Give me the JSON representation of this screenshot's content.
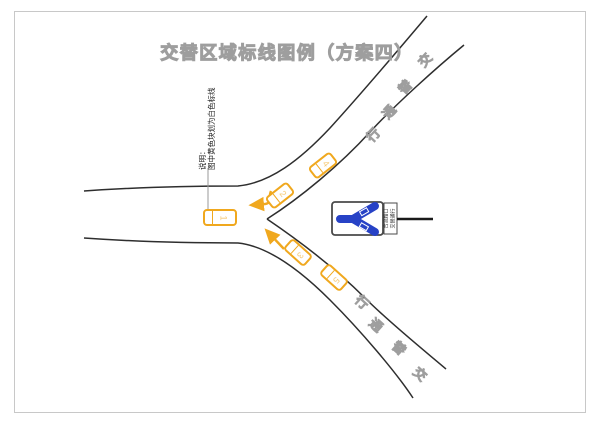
{
  "title": "交替区域标线图例（方案四）",
  "note": {
    "prefix": "说明：",
    "text": "图中黄色块划为白色标线"
  },
  "cars": [
    {
      "number": "1"
    },
    {
      "number": "2"
    },
    {
      "number": "3"
    },
    {
      "number": "4"
    },
    {
      "number": "5"
    }
  ],
  "branches": {
    "upper": {
      "reading": "交替通行",
      "chars": [
        "行",
        "通",
        "替",
        "交"
      ]
    },
    "lower": {
      "reading": "交替通行",
      "chars": [
        "行",
        "通",
        "替",
        "交"
      ]
    }
  },
  "sign": {
    "symbol": "merge-y-left-icon",
    "plate_line1": "合流路口",
    "plate_line2": "交替通行"
  },
  "colors": {
    "car_yellow": "#F0A81E",
    "sign_blue": "#2742C6",
    "road_line": "#2E2E2E",
    "outline_text": "#9E9E9E",
    "frame": "#C8C8C8",
    "leader": "#9A9A9A"
  }
}
